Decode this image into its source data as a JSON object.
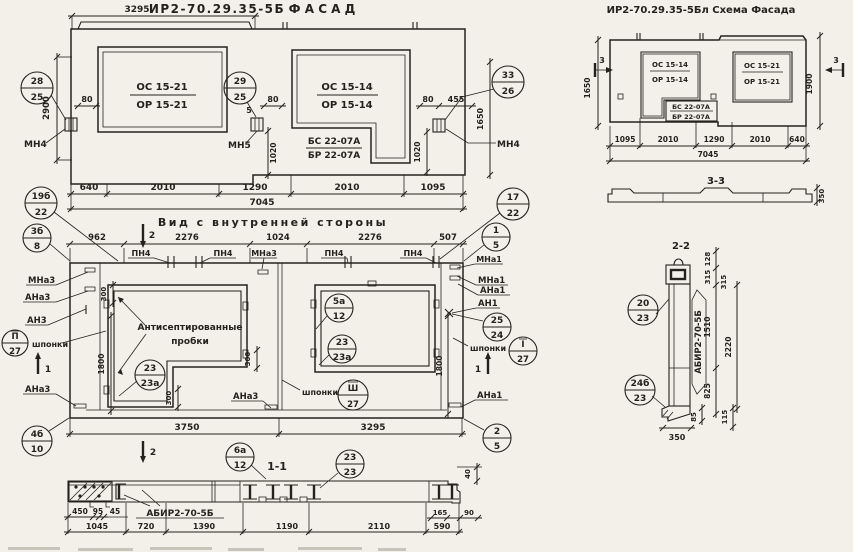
{
  "sheet": {
    "background": "#f2f0e9",
    "ink": "#25221d"
  },
  "facade": {
    "code": "ИР2-70.29.35-5Б",
    "title": "Ф А С А Д",
    "window_left": {
      "top": "ОС 15-21",
      "bottom": "ОР 15-21"
    },
    "window_right": {
      "top": "ОС 15-14",
      "bottom": "ОР 15-14"
    },
    "balcony_block": {
      "top": "БС 22-07А",
      "bottom": "БР 22-07А"
    },
    "anchor_left": "МН4",
    "anchor_mid": "МН5",
    "anchor_right": "МН4",
    "callout_left": {
      "top": "28",
      "bottom": "25"
    },
    "callout_mid": {
      "top": "29",
      "bottom": "25"
    },
    "callout_right": {
      "top": "33",
      "bottom": "26"
    },
    "dim_top": "3295",
    "dim_height": "2900",
    "dim_right_height": "1650",
    "dim_80_left": "80",
    "dim_80_mid": "80",
    "dim_80_right": "80",
    "dim_5": "5",
    "dim_455": "455",
    "dim_1020_left": "1020",
    "dim_1020_right": "1020",
    "dims_bottom": [
      "640",
      "2010",
      "1290",
      "2010",
      "1095"
    ],
    "dim_total": "7045"
  },
  "schema": {
    "title": "ИР2-70.29.35-5Бл Схема Фасада",
    "window_left": {
      "top": "ОС 15-14",
      "bottom": "ОР 15-14"
    },
    "window_right": {
      "top": "ОС 15-21",
      "bottom": "ОР 15-21"
    },
    "balcony_block": {
      "top": "БС 22-07А",
      "bottom": "БР 22-07А"
    },
    "dim_left_height": "1650",
    "dim_right_height": "1900",
    "dims_bottom": [
      "1095",
      "2010",
      "1290",
      "2010",
      "640"
    ],
    "dim_total": "7045",
    "section_mark": "3"
  },
  "section_3_3": {
    "title": "3-3",
    "dim_thickness": "350"
  },
  "section_2_2": {
    "title": "2-2",
    "beam_label": "АБИР2-70-5Б",
    "callout_top": {
      "top": "20",
      "bottom": "23"
    },
    "callout_bottom": {
      "top": "24б",
      "bottom": "23"
    },
    "dim_128": "128",
    "dim_315a": "315",
    "dim_315b": "315",
    "dim_1510": "1510",
    "dim_2220": "2220",
    "dim_825": "825",
    "dim_85": "85",
    "dim_115": "115",
    "dim_350": "350"
  },
  "inner_view": {
    "title": "Вид с внутренней стороны",
    "dims_top": [
      "962",
      "2276",
      "1024",
      "2276",
      "507"
    ],
    "dims_bottom": [
      "3750",
      "3295"
    ],
    "dim_1800_left": "1800",
    "dim_1800_right": "1800",
    "dim_300_a": "300",
    "dim_300_b": "300",
    "dim_300_c": "300",
    "pn4": "ПН4",
    "label_mna3_left": "МНа3",
    "label_ana3_left": "АНа3",
    "label_an3": "АН3",
    "label_shponki_left": "шпонки",
    "label_ana3_bottom_left": "АНа3",
    "label_ana3_bottom_mid": "АНа3",
    "label_mna3_mid": "МНа3",
    "label_mna1": "МНа1",
    "label_ana1_right": "АНа1",
    "label_an1": "АН1",
    "label_shponki_mid": "шпонки",
    "label_shponki_right": "шпонки",
    "label_ana1_bottom_right": "АНа1",
    "note_line1": "Антисептированные",
    "note_line2": "пробки",
    "callout_19b": {
      "top": "19б",
      "bottom": "22"
    },
    "callout_3b": {
      "top": "3б",
      "bottom": "8"
    },
    "callout_17": {
      "top": "17",
      "bottom": "22"
    },
    "callout_1": {
      "top": "1",
      "bottom": "5"
    },
    "callout_shponki_left": {
      "top": "П",
      "bottom": "27"
    },
    "callout_shponki_mid": {
      "top": "Ш",
      "bottom": "27"
    },
    "callout_shponki_right": {
      "top": "I",
      "bottom": "27"
    },
    "callout_25": {
      "top": "25",
      "bottom": "24"
    },
    "callout_5a": {
      "top": "5а",
      "bottom": "12"
    },
    "callout_23_left": {
      "top": "23",
      "bottom": "23а"
    },
    "callout_23_right": {
      "top": "23",
      "bottom": "23а"
    },
    "callout_4b": {
      "top": "4б",
      "bottom": "10"
    },
    "callout_2": {
      "top": "2",
      "bottom": "5"
    },
    "section_mark_1": "1",
    "section_mark_2": "2"
  },
  "section_1_1": {
    "title": "1-1",
    "beam_label": "АБИР2-70-5Б",
    "callout_6a": {
      "top": "6а",
      "bottom": "12"
    },
    "callout_23": {
      "top": "23",
      "bottom": "23"
    },
    "dims_small": [
      "450",
      "95",
      "45"
    ],
    "dims_bottom": [
      "1045",
      "720",
      "1390",
      "1190",
      "2110",
      "590"
    ],
    "dim_165": "165",
    "dim_90": "90",
    "dim_40": "40"
  }
}
